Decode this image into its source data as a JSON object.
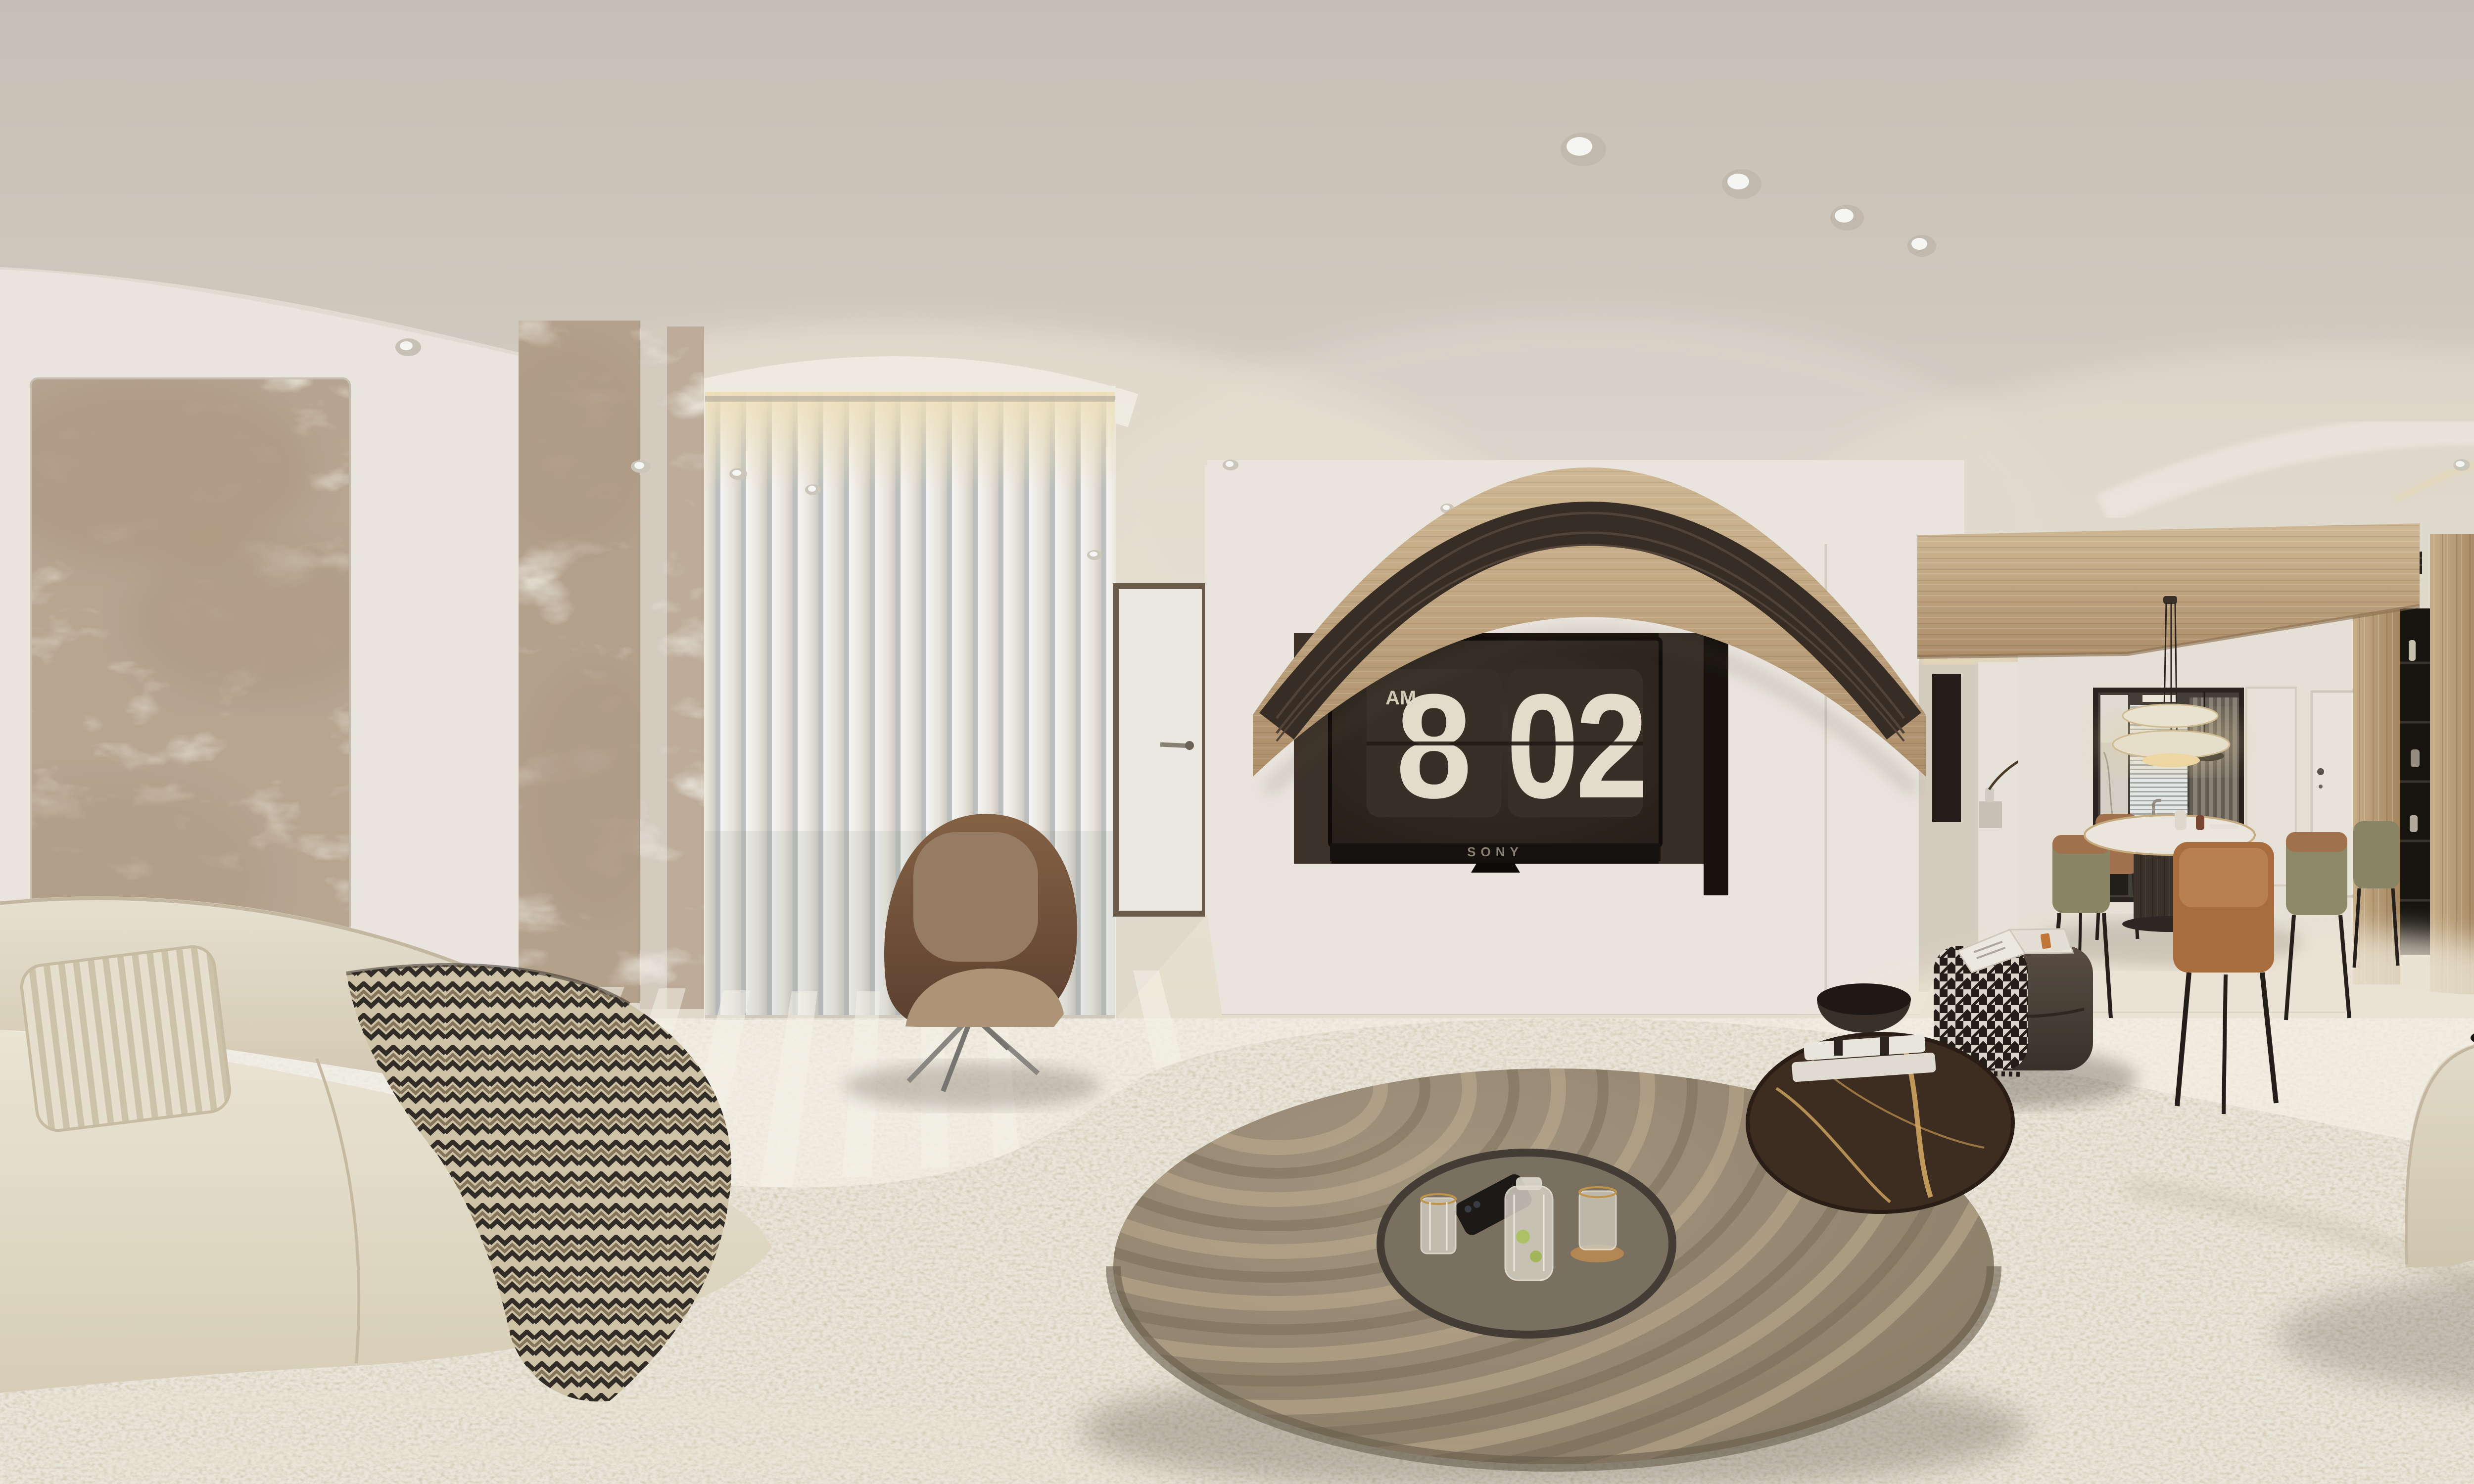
{
  "scene": {
    "type": "equirectangular_360_panorama",
    "setting": "Minimalist cream-toned living room and dining room interior",
    "lighting": "morning daylight through vertical blinds with warm cove lighting"
  },
  "tv": {
    "brand": "SONY",
    "clock_period": "AM",
    "clock_hour": "8",
    "clock_minute": "02"
  },
  "palette": {
    "ceiling": "#d2cbc2",
    "walls": "#f2eee7",
    "floor": "#eae2d2",
    "rug": "#d8cdb8",
    "sofa": "#ebe3d1",
    "oak_wood": "#c8ad88",
    "dark_wood": "#43382d",
    "leather": "#8a6547",
    "coffee_table": "#998b76",
    "figurine_blue": "#8bb9e4"
  },
  "objects": {
    "left_art_panels": "brown-veined marble wall panels",
    "balcony": "floor-to-ceiling vertical blinds with hazy city view",
    "lounge_chair": "brown leather swivel lounge chair",
    "tv": "wall-mounted TV with flip-clock screensaver in dark niche",
    "valance": "curved oak valance with slatted AC grille",
    "coffee_table": "huge round taupe coffee table with ripple light bands",
    "tray": "black round tray with carafe, ribbed glasses and phone",
    "side_table": "dark gold-veined marble side table with books and black bowl",
    "ottoman": "dark leather pouf with houndstooth throw and open magazine",
    "dining_table": "round white dining table on dark wood cylinder base",
    "dining_chairs": "leather dining chairs in tan and olive",
    "pendant": "triple-disc pendant lamp over dining table",
    "kitchen": "glass-enclosed kitchen with venetian blinds and marble splashback",
    "wardrobe": "dark oak wardrobe wall with oak panels and black shelf niche",
    "figurine": "blue angel art toy sitting on stacked books",
    "sofas": "curved cream modular fabric sofas",
    "throws": "zigzag knit throw and ribbed pillow"
  }
}
